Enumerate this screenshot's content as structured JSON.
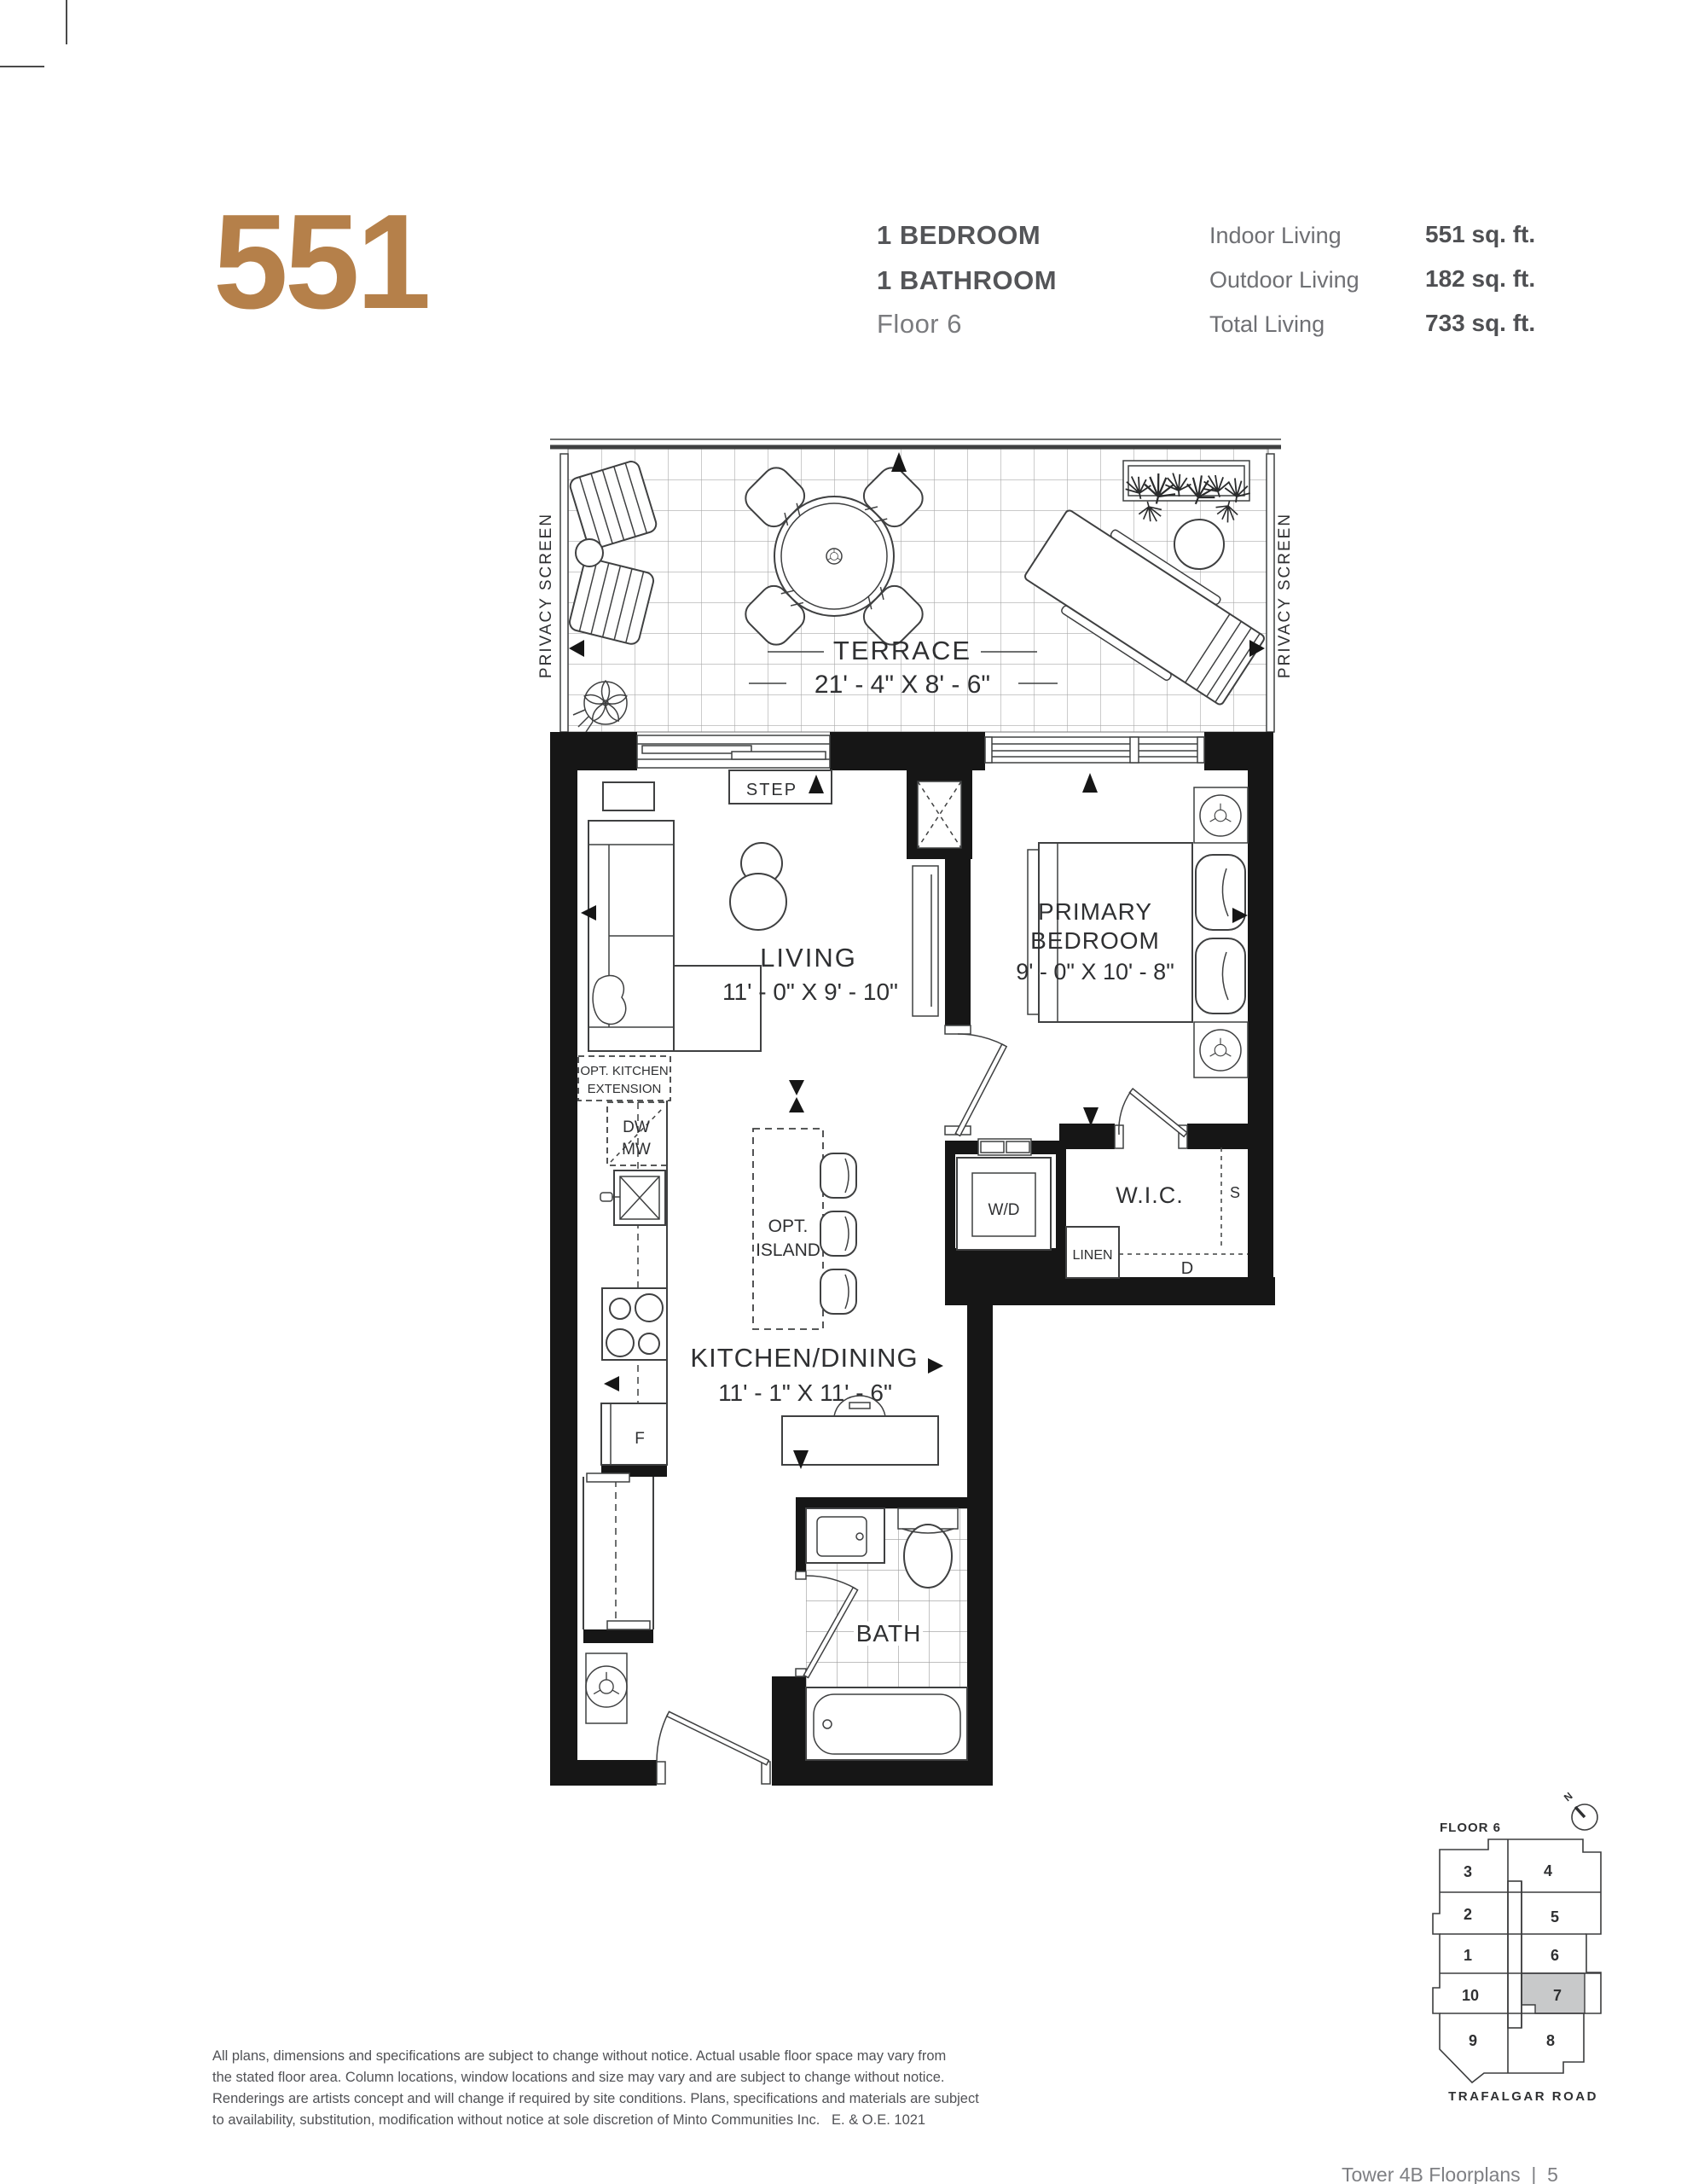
{
  "page": {
    "footer_text": "Tower 4B Floorplans  |  5"
  },
  "header": {
    "unit_number": "551",
    "bedrooms_label": "1 BEDROOM",
    "bathrooms_label": "1 BATHROOM",
    "floor_label": "Floor 6",
    "stats": [
      {
        "label": "Indoor Living",
        "value": "551 sq. ft."
      },
      {
        "label": "Outdoor Living",
        "value": "182 sq. ft."
      },
      {
        "label": "Total Living",
        "value": "733 sq. ft."
      }
    ]
  },
  "floorplan": {
    "terrace": {
      "name": "TERRACE",
      "dim": "21' - 4\" X 8' - 6\"",
      "privacy_screen": "PRIVACY SCREEN"
    },
    "living": {
      "name": "LIVING",
      "dim": "11' - 0\" X 9' - 10\""
    },
    "primary_bedroom": {
      "name_line1": "PRIMARY",
      "name_line2": "BEDROOM",
      "dim": "9' - 0\" X 10' - 8\""
    },
    "kitchen_dining": {
      "name": "KITCHEN/DINING",
      "dim": "11' - 1\" X 11' - 6\"",
      "opt_island_line1": "OPT.",
      "opt_island_line2": "ISLAND",
      "opt_extension_line1": "OPT. KITCHEN",
      "opt_extension_line2": "EXTENSION",
      "dishwasher": "DW",
      "microwave": "MW",
      "fridge": "F"
    },
    "bath": {
      "name": "BATH"
    },
    "labels": {
      "step": "STEP",
      "washer_dryer": "W/D",
      "wic": "W.I.C.",
      "linen": "LINEN",
      "shelf": "S",
      "dresser": "D"
    }
  },
  "keyplan": {
    "title": "FLOOR 6",
    "north_label": "N",
    "street": "TRAFALGAR ROAD",
    "highlighted_unit": "7",
    "units": [
      "3",
      "4",
      "2",
      "5",
      "1",
      "6",
      "10",
      "7",
      "9",
      "8"
    ]
  },
  "disclaimer": {
    "lines": [
      "All plans, dimensions and specifications are subject to change without notice. Actual usable floor space may vary from",
      "the stated floor area. Column locations, window locations and size may vary and are subject to change without notice.",
      "Renderings are artists concept and will change if required by site conditions. Plans, specifications and materials are subject",
      "to availability, substitution, modification without notice at sole discretion of Minto Communities Inc.   E. & O.E. 1021"
    ]
  },
  "colors": {
    "accent": "#b5804a",
    "unit_highlight": "#c8c9ca",
    "wall": "#161616",
    "line": "#3f4041",
    "text_dark": "#58595b",
    "text_medium": "#77787b"
  }
}
